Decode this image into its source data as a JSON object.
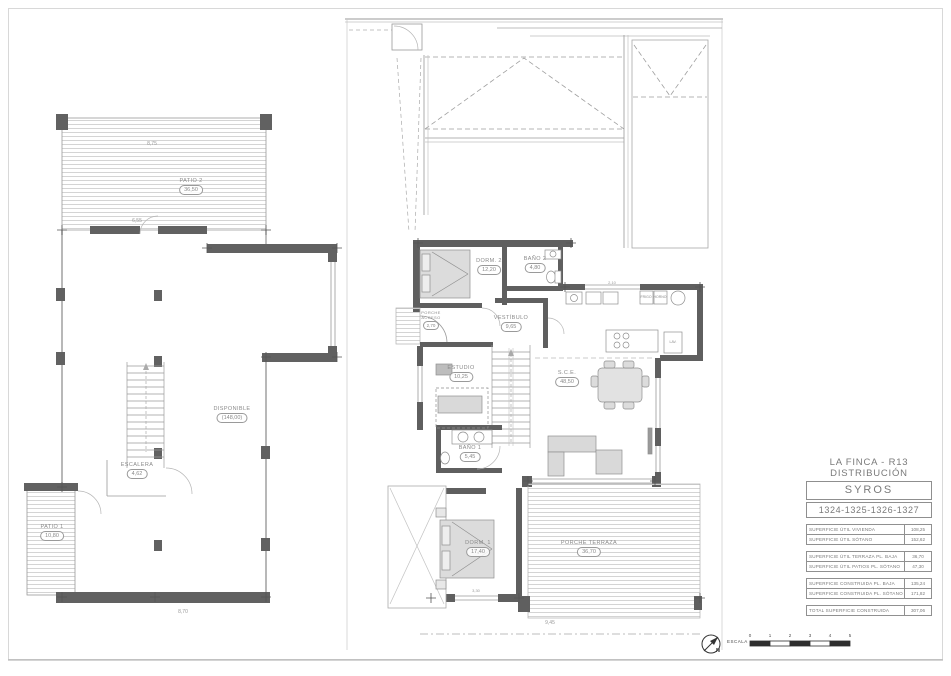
{
  "title_block": {
    "project_line1": "LA FINCA - R13",
    "project_line2": "DISTRIBUCIÓN",
    "model_name": "SYROS",
    "plot_numbers": "1324-1325-1326-1327",
    "area_rows": [
      {
        "label": "SUPERFICIE ÚTIL VIVIENDA",
        "value": "108,25"
      },
      {
        "label": "SUPERFICIE ÚTIL SÓTANO",
        "value": "152,62"
      },
      {
        "label": "SUPERFICIE ÚTIL TERRAZA PL. BAJA",
        "value": "36,70"
      },
      {
        "label": "SUPERFICIE ÚTIL PATIOS PL. SÓTANO",
        "value": "47,30"
      },
      {
        "label": "SUPERFICIE CONSTRUIDA PL. BAJA",
        "value": "135,24"
      },
      {
        "label": "SUPERFICIE CONSTRUIDA PL. SÓTANO",
        "value": "171,82"
      },
      {
        "label": "TOTAL SUPERFICIE CONSTRUIDA",
        "value": "307,06"
      }
    ]
  },
  "scale_bar": {
    "north_label": "N",
    "escala_label": "ESCALA",
    "ticks": [
      "0",
      "1",
      "2",
      "3",
      "4",
      "5"
    ]
  },
  "basement_plan": {
    "rooms": {
      "patio2": {
        "name": "PATIO 2",
        "area": "36,50"
      },
      "disponible": {
        "name": "DISPONIBLE",
        "area": "(148,00)"
      },
      "escalera": {
        "name": "ESCALERA",
        "area": "4,62"
      },
      "patio1": {
        "name": "PATIO 1",
        "area": "10,80"
      }
    },
    "dimensions": {
      "top_width": "8,75",
      "inner_width": "6,55",
      "bottom_width": "8,70"
    }
  },
  "ground_plan": {
    "rooms": {
      "dorm2": {
        "name": "DORM. 2",
        "area": "12,20"
      },
      "bano2": {
        "name": "BAÑO 2",
        "area": "4,80"
      },
      "vestibulo": {
        "name": "VESTÍBULO",
        "area": "9,65"
      },
      "acceso": {
        "name": "PORCHE ACCESO",
        "area": "2,70"
      },
      "estudio": {
        "name": "ESTUDIO",
        "area": "10,25"
      },
      "sce": {
        "name": "S.C.E.",
        "area": "48,50"
      },
      "bano1": {
        "name": "BAÑO 1",
        "area": "5,45"
      },
      "dorm1": {
        "name": "DORM. 1",
        "area": "17,40"
      },
      "porche": {
        "name": "PORCHE TERRAZA",
        "area": "36,70"
      }
    },
    "appliances": {
      "fridge": "FRIGO",
      "oven": "HORNO",
      "washer": "LAV."
    },
    "dimensions": {
      "kitchen_counter": "2,10",
      "dorm1_window": "3,30",
      "terrace_width": "9,45"
    }
  }
}
